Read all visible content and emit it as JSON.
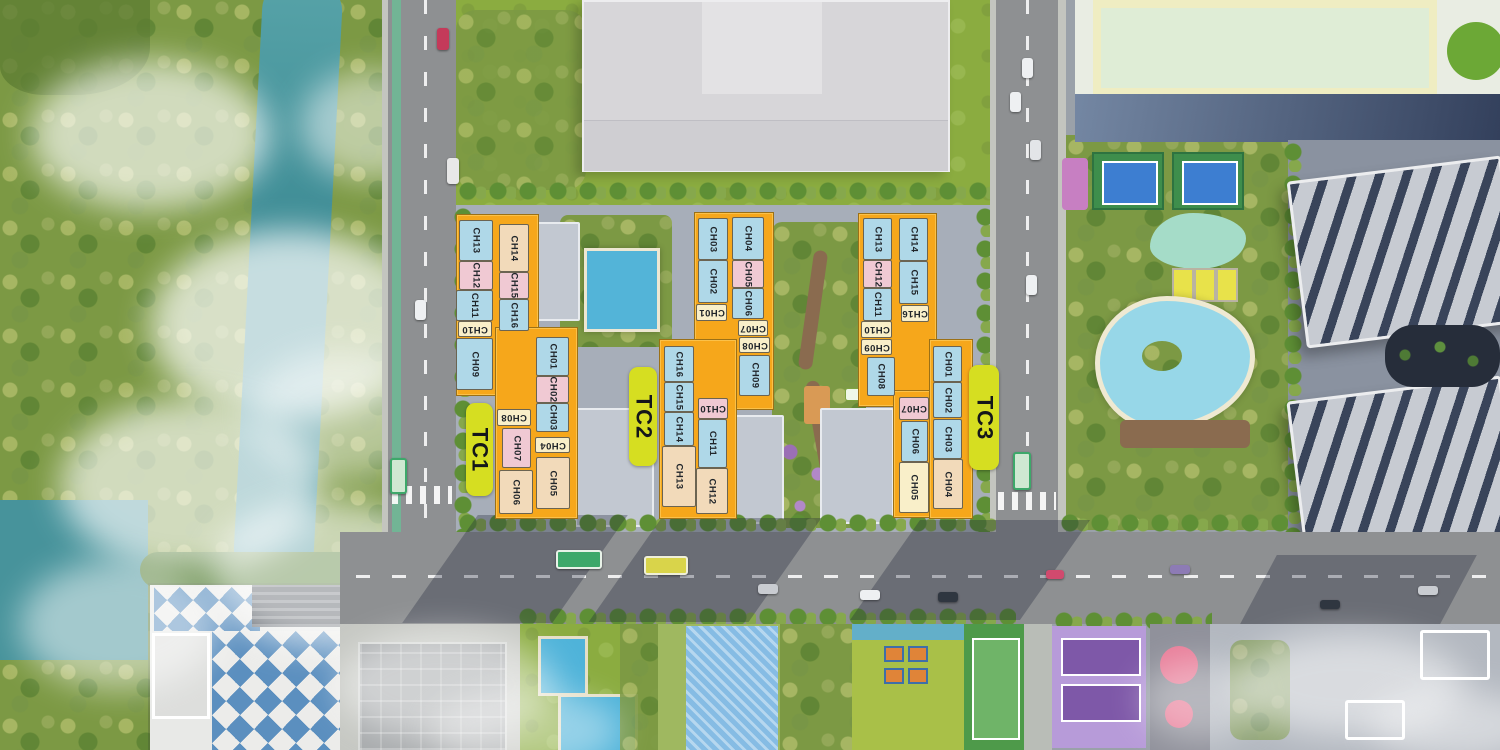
{
  "site_plan": {
    "palette": {
      "block_orange": "#F6A71B",
      "tower_label_green": "#D6DE21",
      "unit_blue": "#AFD8E8",
      "unit_pink": "#F0C9D3",
      "unit_cream": "#F9EFC9",
      "unit_tan": "#F2DABA",
      "river_teal": "#3F8D96",
      "pool_blue": "#53B4D8",
      "road_gray": "#8E9092",
      "forest_green": "#7C9944"
    },
    "towers": [
      {
        "id": "TC1",
        "label": "TC1",
        "label_box": {
          "x": 466,
          "y": 403,
          "w": 27,
          "h": 93
        },
        "footprint": [
          {
            "x": 456,
            "y": 214,
            "w": 81,
            "h": 180
          },
          {
            "x": 495,
            "y": 327,
            "w": 81,
            "h": 190
          }
        ],
        "units": [
          {
            "label": "CH13",
            "color": "blue",
            "rot": 90,
            "x": 459,
            "y": 220,
            "w": 34,
            "h": 41
          },
          {
            "label": "CH12",
            "color": "pink",
            "rot": 90,
            "x": 459,
            "y": 261,
            "w": 34,
            "h": 29
          },
          {
            "label": "CH11",
            "color": "blue",
            "rot": 90,
            "x": 456,
            "y": 290,
            "w": 37,
            "h": 31
          },
          {
            "label": "CH10",
            "color": "cream",
            "rot": 180,
            "x": 458,
            "y": 321,
            "w": 34,
            "h": 16
          },
          {
            "label": "CH09",
            "color": "blue",
            "rot": 90,
            "x": 456,
            "y": 338,
            "w": 37,
            "h": 52
          },
          {
            "label": "CH14",
            "color": "tan",
            "rot": 90,
            "x": 499,
            "y": 224,
            "w": 30,
            "h": 48
          },
          {
            "label": "CH15",
            "color": "pink",
            "rot": 90,
            "x": 499,
            "y": 272,
            "w": 30,
            "h": 27
          },
          {
            "label": "CH16",
            "color": "blue",
            "rot": 90,
            "x": 499,
            "y": 299,
            "w": 30,
            "h": 32
          },
          {
            "label": "CH01",
            "color": "blue",
            "rot": 90,
            "x": 536,
            "y": 337,
            "w": 33,
            "h": 39
          },
          {
            "label": "CH02",
            "color": "pink",
            "rot": 90,
            "x": 536,
            "y": 376,
            "w": 33,
            "h": 27
          },
          {
            "label": "CH03",
            "color": "blue",
            "rot": 90,
            "x": 536,
            "y": 403,
            "w": 33,
            "h": 29
          },
          {
            "label": "CH04",
            "color": "cream",
            "rot": 180,
            "x": 535,
            "y": 437,
            "w": 35,
            "h": 16
          },
          {
            "label": "CH05",
            "color": "tan",
            "rot": 90,
            "x": 536,
            "y": 457,
            "w": 34,
            "h": 52
          },
          {
            "label": "CH08",
            "color": "cream",
            "rot": 180,
            "x": 497,
            "y": 409,
            "w": 34,
            "h": 17
          },
          {
            "label": "CH07",
            "color": "pink",
            "rot": 90,
            "x": 502,
            "y": 428,
            "w": 29,
            "h": 40
          },
          {
            "label": "CH06",
            "color": "tan",
            "rot": 90,
            "x": 499,
            "y": 470,
            "w": 34,
            "h": 44
          }
        ]
      },
      {
        "id": "TC2",
        "label": "TC2",
        "label_box": {
          "x": 629,
          "y": 367,
          "w": 28,
          "h": 99
        },
        "footprint": [
          {
            "x": 694,
            "y": 212,
            "w": 78,
            "h": 196
          },
          {
            "x": 659,
            "y": 339,
            "w": 76,
            "h": 178
          }
        ],
        "units": [
          {
            "label": "CH03",
            "color": "blue",
            "rot": 90,
            "x": 698,
            "y": 218,
            "w": 30,
            "h": 42
          },
          {
            "label": "CH02",
            "color": "blue",
            "rot": 90,
            "x": 698,
            "y": 260,
            "w": 30,
            "h": 43
          },
          {
            "label": "CH01",
            "color": "cream",
            "rot": 180,
            "x": 696,
            "y": 304,
            "w": 31,
            "h": 17
          },
          {
            "label": "CH04",
            "color": "blue",
            "rot": 90,
            "x": 732,
            "y": 217,
            "w": 32,
            "h": 43
          },
          {
            "label": "CH05",
            "color": "pink",
            "rot": 90,
            "x": 732,
            "y": 260,
            "w": 32,
            "h": 28
          },
          {
            "label": "CH06",
            "color": "blue",
            "rot": 90,
            "x": 732,
            "y": 288,
            "w": 32,
            "h": 31
          },
          {
            "label": "CH07",
            "color": "cream",
            "rot": 180,
            "x": 738,
            "y": 320,
            "w": 30,
            "h": 16
          },
          {
            "label": "CH08",
            "color": "cream",
            "rot": 180,
            "x": 739,
            "y": 337,
            "w": 31,
            "h": 16
          },
          {
            "label": "CH09",
            "color": "blue",
            "rot": 90,
            "x": 739,
            "y": 355,
            "w": 31,
            "h": 41
          },
          {
            "label": "CH16",
            "color": "blue",
            "rot": 90,
            "x": 664,
            "y": 346,
            "w": 30,
            "h": 36
          },
          {
            "label": "CH15",
            "color": "blue",
            "rot": 90,
            "x": 664,
            "y": 382,
            "w": 30,
            "h": 30
          },
          {
            "label": "CH14",
            "color": "blue",
            "rot": 90,
            "x": 664,
            "y": 412,
            "w": 30,
            "h": 34
          },
          {
            "label": "CH13",
            "color": "tan",
            "rot": 90,
            "x": 662,
            "y": 446,
            "w": 34,
            "h": 61
          },
          {
            "label": "CH10",
            "color": "pink",
            "rot": 180,
            "x": 698,
            "y": 398,
            "w": 30,
            "h": 21
          },
          {
            "label": "CH11",
            "color": "blue",
            "rot": 90,
            "x": 698,
            "y": 419,
            "w": 29,
            "h": 49
          },
          {
            "label": "CH12",
            "color": "tan",
            "rot": 90,
            "x": 696,
            "y": 468,
            "w": 32,
            "h": 46
          }
        ]
      },
      {
        "id": "TC3",
        "label": "TC3",
        "label_box": {
          "x": 969,
          "y": 365,
          "w": 30,
          "h": 105
        },
        "footprint": [
          {
            "x": 858,
            "y": 213,
            "w": 77,
            "h": 192
          },
          {
            "x": 893,
            "y": 390,
            "w": 40,
            "h": 126
          },
          {
            "x": 929,
            "y": 339,
            "w": 42,
            "h": 178
          }
        ],
        "units": [
          {
            "label": "CH13",
            "color": "blue",
            "rot": 90,
            "x": 863,
            "y": 218,
            "w": 29,
            "h": 42
          },
          {
            "label": "CH12",
            "color": "pink",
            "rot": 90,
            "x": 863,
            "y": 260,
            "w": 29,
            "h": 28
          },
          {
            "label": "CH11",
            "color": "blue",
            "rot": 90,
            "x": 863,
            "y": 288,
            "w": 29,
            "h": 33
          },
          {
            "label": "CH10",
            "color": "cream",
            "rot": 180,
            "x": 861,
            "y": 321,
            "w": 31,
            "h": 17
          },
          {
            "label": "CH09",
            "color": "cream",
            "rot": 180,
            "x": 861,
            "y": 339,
            "w": 31,
            "h": 16
          },
          {
            "label": "CH08",
            "color": "blue",
            "rot": 90,
            "x": 867,
            "y": 357,
            "w": 28,
            "h": 39
          },
          {
            "label": "CH14",
            "color": "blue",
            "rot": 90,
            "x": 899,
            "y": 218,
            "w": 29,
            "h": 43
          },
          {
            "label": "CH15",
            "color": "blue",
            "rot": 90,
            "x": 899,
            "y": 261,
            "w": 29,
            "h": 43
          },
          {
            "label": "CH16",
            "color": "cream",
            "rot": 180,
            "x": 901,
            "y": 305,
            "w": 28,
            "h": 17
          },
          {
            "label": "CH07",
            "color": "pink",
            "rot": 180,
            "x": 899,
            "y": 397,
            "w": 30,
            "h": 23
          },
          {
            "label": "CH06",
            "color": "blue",
            "rot": 90,
            "x": 901,
            "y": 421,
            "w": 27,
            "h": 41
          },
          {
            "label": "CH05",
            "color": "cream",
            "rot": 90,
            "x": 899,
            "y": 462,
            "w": 30,
            "h": 51
          },
          {
            "label": "CH01",
            "color": "blue",
            "rot": 90,
            "x": 933,
            "y": 346,
            "w": 29,
            "h": 36
          },
          {
            "label": "CH02",
            "color": "blue",
            "rot": 90,
            "x": 933,
            "y": 382,
            "w": 29,
            "h": 36
          },
          {
            "label": "CH03",
            "color": "blue",
            "rot": 90,
            "x": 933,
            "y": 419,
            "w": 29,
            "h": 40
          },
          {
            "label": "CH04",
            "color": "tan",
            "rot": 90,
            "x": 933,
            "y": 459,
            "w": 30,
            "h": 50
          }
        ]
      }
    ]
  }
}
